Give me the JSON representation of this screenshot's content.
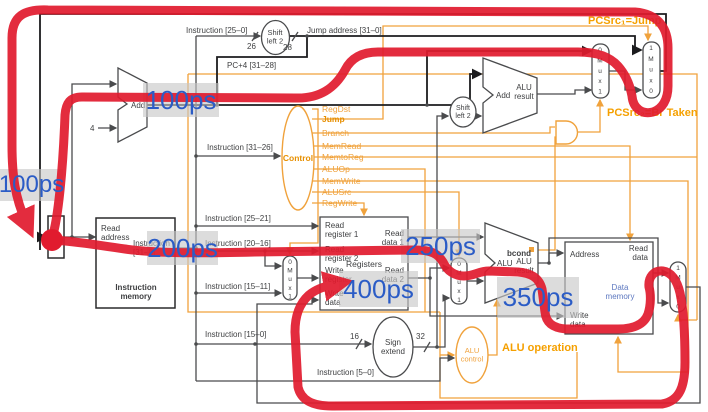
{
  "colors": {
    "red": "#e11b2e",
    "blue": "#2b5cc6",
    "orange": "#f0a23c",
    "orange_dark": "#e78f00",
    "wire_gray": "#4a4b4d",
    "wire_black": "#1c1c1e",
    "data_memory_text": "#5d78c0",
    "timing_bg": "rgba(198,198,198,0.62)"
  },
  "timings": [
    "100ps",
    "100ps",
    "200ps",
    "250ps",
    "400ps",
    "350ps"
  ],
  "annotations": {
    "pcsrc1": "PCSrc₁=Jump",
    "pcsrc2": "PCSrc₂=Br Taken",
    "alu_operation": "ALU operation"
  },
  "control": {
    "label": "Control",
    "signals": [
      "RegDst",
      "Jump",
      "Branch",
      "MemRead",
      "MemtoReg",
      "ALUOp",
      "MemWrite",
      "ALUSrc",
      "RegWrite"
    ]
  },
  "wire_labels": {
    "instr_25_0": "Instruction [25–0]",
    "jump_addr": "Jump address [31–0]",
    "pc4": "PC+4 [31–28]",
    "instr_31_26": "Instruction [31–26]",
    "instr_25_21": "Instruction [25–21]",
    "instr_20_16": "Instruction [20–16]",
    "instr_15_11": "Instruction [15–11]",
    "instr_15_0": "Instruction [15–0]",
    "instr_5_0": "Instruction [5–0]",
    "w26": "26",
    "w28": "28",
    "w4": "4",
    "w16": "16",
    "w32": "32"
  },
  "blocks": {
    "pc": "PC",
    "imem_title": "Instruction\nmemory",
    "imem_read_addr": "Read\naddress",
    "imem_out": "Instruction\n[31–0]",
    "add": "Add",
    "add_result": "ALU\nresult",
    "shift": "Shift\nleft 2",
    "sign": "Sign\nextend",
    "alu_ctl": "ALU\ncontrol",
    "alu": "ALU",
    "alu_result": "ALU\nresult",
    "bcond": "bcond",
    "regs_title": "Registers",
    "rr1": "Read\nregister 1",
    "rr2": "Read\nregister 2",
    "wreg": "Write\nregister",
    "wdata": "Write\ndata",
    "rd1": "Read\ndata 1",
    "rd2": "Read\ndata 2",
    "dmem_title": "Data\nmemory",
    "addr": "Address",
    "rdata": "Read\ndata",
    "dmem_wdata": "Write\ndata"
  },
  "muxes": {
    "m01": "0\nM\nu\nx\n1",
    "m10": "1\nM\nu\nx\n0"
  }
}
